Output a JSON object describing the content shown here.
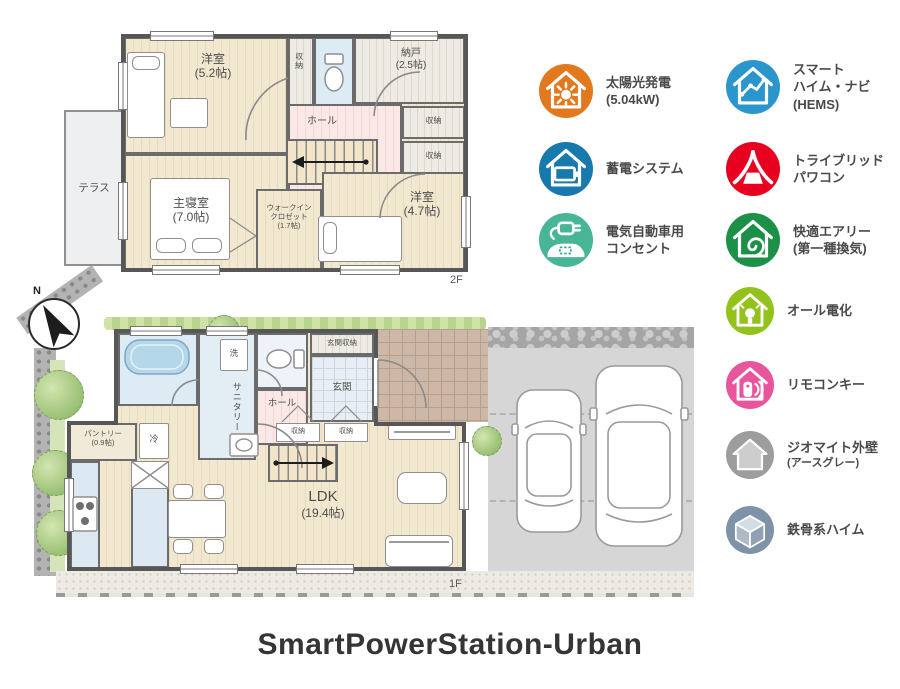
{
  "title": "SmartPowerStation-Urban",
  "compass": {
    "label": "N"
  },
  "floor2": {
    "floor_label": "2F",
    "terrace": "テラス",
    "rooms": {
      "bedroom52": {
        "lines": [
          "洋室",
          "(5.2帖)"
        ]
      },
      "closet_top": {
        "lines": [
          "収納"
        ]
      },
      "nando": {
        "lines": [
          "納戸",
          "(2.5帖)"
        ]
      },
      "hall": {
        "lines": [
          "ホール"
        ]
      },
      "storage_r1": {
        "lines": [
          "収納"
        ]
      },
      "storage_r2": {
        "lines": [
          "収納"
        ]
      },
      "master": {
        "lines": [
          "主寝室",
          "(7.0帖)"
        ]
      },
      "wic": {
        "lines": [
          "ウォークイン",
          "クロゼット",
          "(1.7帖)"
        ]
      },
      "bedroom47": {
        "lines": [
          "洋室",
          "(4.7帖)"
        ]
      }
    }
  },
  "floor1": {
    "floor_label": "1F",
    "rooms": {
      "sanitary": {
        "lines": [
          "サニタリー"
        ]
      },
      "wash": {
        "lines": [
          "洗"
        ]
      },
      "hall": {
        "lines": [
          "ホール"
        ]
      },
      "genkan_storage": {
        "lines": [
          "玄関収納"
        ]
      },
      "genkan": {
        "lines": [
          "玄関"
        ]
      },
      "storage_a": {
        "lines": [
          "収納"
        ]
      },
      "storage_b": {
        "lines": [
          "収納"
        ]
      },
      "pantry": {
        "lines": [
          "パントリー",
          "(0.9帖)"
        ]
      },
      "fridge": {
        "lines": [
          "冷"
        ]
      },
      "ldk": {
        "lines": [
          "LDK",
          "(19.4帖)"
        ]
      }
    }
  },
  "legend": {
    "items": [
      {
        "name": "solar-power",
        "icon": "sun-house-icon",
        "color": "#e2791e",
        "lines": [
          "太陽光発電",
          "(5.04kW)"
        ]
      },
      {
        "name": "smart-heim-navi",
        "icon": "graph-house-icon",
        "color": "#2b96cc",
        "lines": [
          "スマート",
          "ハイム・ナビ",
          "(HEMS)"
        ]
      },
      {
        "name": "storage-battery",
        "icon": "battery-house-icon",
        "color": "#1879ad",
        "lines": [
          "蓄電システム"
        ]
      },
      {
        "name": "tribrid-powercon",
        "icon": "tribrid-icon",
        "color": "#e7001f",
        "lines": [
          "トライブリッド",
          "パワコン"
        ]
      },
      {
        "name": "ev-outlet",
        "icon": "ev-plug-icon",
        "color": "#47b596",
        "lines": [
          "電気自動車用",
          "コンセント"
        ]
      },
      {
        "name": "kaiteki-airy",
        "icon": "spiral-house-icon",
        "color": "#1d9048",
        "lines": [
          "快適エアリー",
          "(第一種換気)"
        ]
      },
      {
        "name": "all-electric",
        "icon": "bulb-house-icon",
        "color": "#93c21d",
        "lines": [
          "オール電化"
        ]
      },
      {
        "name": "remote-key",
        "icon": "key-house-icon",
        "color": "#e8559c",
        "lines": [
          "リモコンキー"
        ]
      },
      {
        "name": "geomite-wall",
        "icon": "gray-house-icon",
        "color": "#9d9d9e",
        "lines": [
          "ジオマイト外壁",
          "(アースグレー)"
        ]
      },
      {
        "name": "steel-heim",
        "icon": "cube-icon",
        "color": "#7e93a7",
        "lines": [
          "鉄骨系ハイム"
        ]
      }
    ]
  }
}
